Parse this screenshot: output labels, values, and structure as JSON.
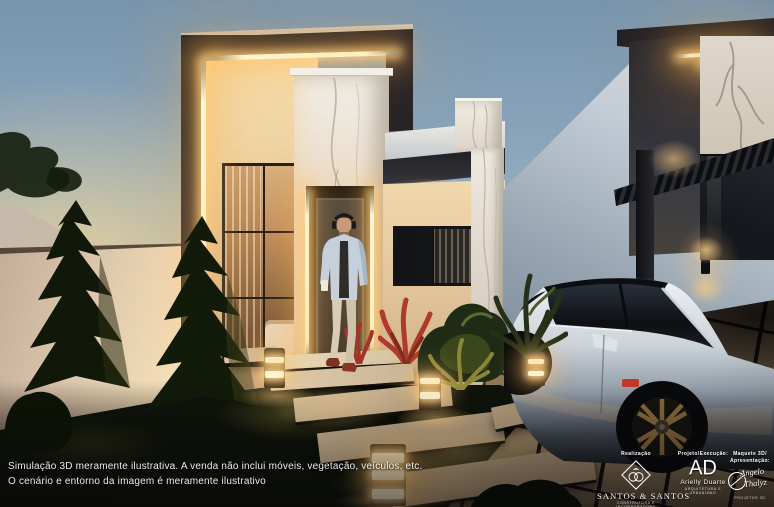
{
  "meta": {
    "image_type": "3D architectural exterior rendering",
    "scene_description": "Modern flat-roof single-story house at dusk with LED strip lighting, marble-clad entry, man walking out of front door, landscaped yard with bollard path lights, stepping stones, and a white hatchback parked under a neighbor carport"
  },
  "disclaimer": {
    "line1": "Simulação 3D meramente ilustrativa. A venda não inclui móveis, vegetação, veículos, etc.",
    "line2": "O cenário e entorno da imagem é meramente ilustrativo"
  },
  "credits": {
    "realizacao": {
      "label": "Realização",
      "company": "SANTOS & SANTOS",
      "tagline": "CONSTRUTORA E INCORPORADORA"
    },
    "projeto": {
      "label": "Projeto/Execução:",
      "monogram": "AD",
      "name": "Arielly Duarte",
      "tagline": "ARQUITETURA E URBANISMO"
    },
    "maquete": {
      "label1": "Maquete 3D/",
      "label2": "Apresentação:",
      "sig1": "Angelo",
      "sig2": "Thalyz",
      "tagline": "PROJETOS 3D"
    }
  },
  "palette": {
    "sky_top": "#7d9cb5",
    "sky_horizon_warm": "#eedcae",
    "led_warm": "#ffedba",
    "charcoal_band": "#26242a",
    "marble": "#ece7de",
    "warm_wall": "#ecd3a6",
    "grass_dark": "#10150c",
    "paver": "#94805f",
    "car_body": "#dfe3e8",
    "flower_red": "#b03a29"
  },
  "scene_objects": [
    "sky-dusk-gradient",
    "left-boundary-wall",
    "conifer-trees",
    "main-house",
    "led-strip-lighting",
    "marble-entry-tower",
    "front-door",
    "walking-man",
    "picture-window",
    "neighbor-house",
    "carport-pergola",
    "white-hatchback-car",
    "front-lawn",
    "stepping-stones",
    "bollard-lights",
    "red-flower-shrubs",
    "driveway-pavers",
    "wall-sconce"
  ]
}
